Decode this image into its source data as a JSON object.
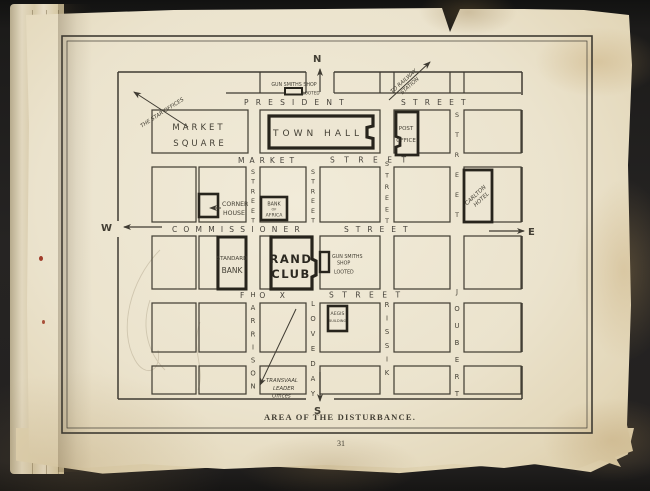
{
  "page": {
    "number": "31",
    "caption": "AREA OF THE DISTURBANCE."
  },
  "compass": {
    "north": "N",
    "south": "S",
    "west": "W",
    "east": "E"
  },
  "streets": {
    "president": {
      "name": "PRESIDENT",
      "suffix": "STREET"
    },
    "market": {
      "name": "MARKET",
      "suffix": "STREET"
    },
    "commissioner": {
      "name": "COMMISSIONER",
      "suffix": "STREET"
    },
    "fox": {
      "name": "FOX",
      "suffix": "STREET"
    },
    "harrison": {
      "name": "HARRISON",
      "suffix": "STREET"
    },
    "loveday": {
      "name": "LOVEDAY",
      "suffix": "STREET"
    },
    "rissik": {
      "name": "RISSIK",
      "suffix": "STREET"
    },
    "joubert": {
      "name": "JOUBERT",
      "suffix": "STREET"
    }
  },
  "places": {
    "market_square": {
      "l1": "MARKET",
      "l2": "SQUARE"
    },
    "town_hall": {
      "l1": "TOWN HALL"
    },
    "post_office": {
      "l1": "POST",
      "l2": "OFFICE"
    },
    "corner_house": {
      "l1": "CORNER",
      "l2": "HOUSE"
    },
    "bank_of_africa": {
      "l1": "BANK",
      "l2": "OF",
      "l3": "AFRICA"
    },
    "standard_bank": {
      "l1": "STANDARD",
      "l2": "BANK"
    },
    "rand_club": {
      "l1": "RAND",
      "l2": "CLUB"
    },
    "carlton_hotel": {
      "l1": "CARLTON",
      "l2": "HOTEL"
    },
    "aegis_building": {
      "l1": "AEGIS",
      "l2": "BUILDING"
    },
    "gunsmith_north": {
      "l1": "GUN SMITHS SHOP",
      "l2": "LOOTED"
    },
    "gunsmith_south": {
      "l1": "GUN SMITHS",
      "l2": "SHOP",
      "l3": "LOOTED"
    }
  },
  "annotations": {
    "star_offices": "THE STAR OFFICES",
    "railway": {
      "l1": "TO RAILWAY",
      "l2": "STATION"
    },
    "leader": {
      "l1": "TRANSVAAL",
      "l2": "LEADER",
      "l3": "Offices"
    }
  },
  "colors": {
    "ink": "#3f3b32",
    "paper": "#ebe3cd",
    "background": "#232120",
    "speck": "#a03c2a"
  }
}
